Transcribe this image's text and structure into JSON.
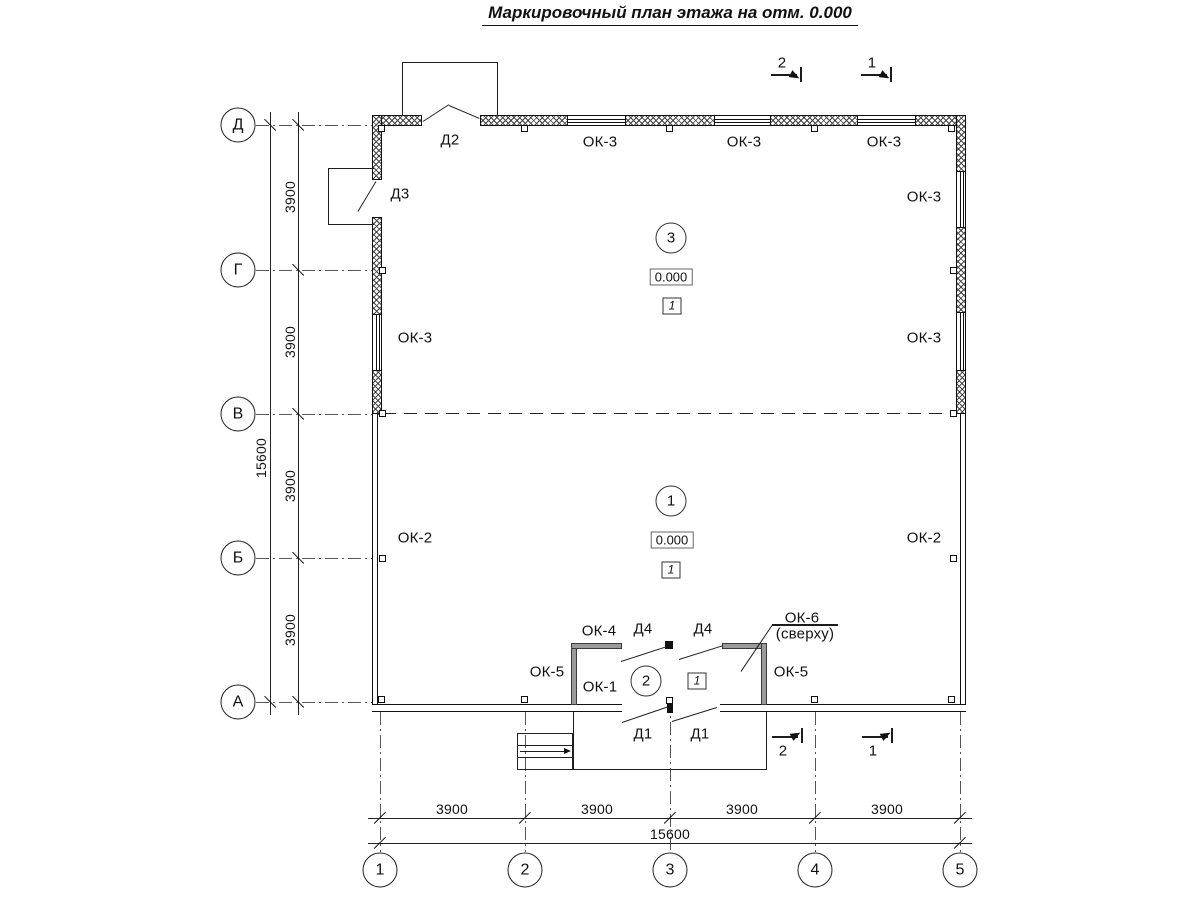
{
  "title": "Маркировочный план этажа на отм. 0.000",
  "axes": {
    "rows": [
      "Д",
      "Г",
      "В",
      "Б",
      "А"
    ],
    "cols": [
      "1",
      "2",
      "3",
      "4",
      "5"
    ]
  },
  "dimensions": {
    "segment": "3900",
    "total": "15600"
  },
  "marks": {
    "ok1": "ОК-1",
    "ok2": "ОК-2",
    "ok3": "ОК-3",
    "ok4": "ОК-4",
    "ok5": "ОК-5",
    "ok6": "ОК-6",
    "ok6_note": "(сверху)",
    "d1": "Д1",
    "d2": "Д2",
    "d3": "Д3",
    "d4": "Д4"
  },
  "rooms": {
    "upper": {
      "number": "3",
      "elevation": "0.000",
      "finish_ref": "1"
    },
    "lower": {
      "number": "1",
      "elevation": "0.000",
      "finish_ref": "1"
    },
    "tambour": {
      "number": "2",
      "finish_ref": "1"
    }
  },
  "sections": {
    "s1": "1",
    "s2": "2"
  }
}
